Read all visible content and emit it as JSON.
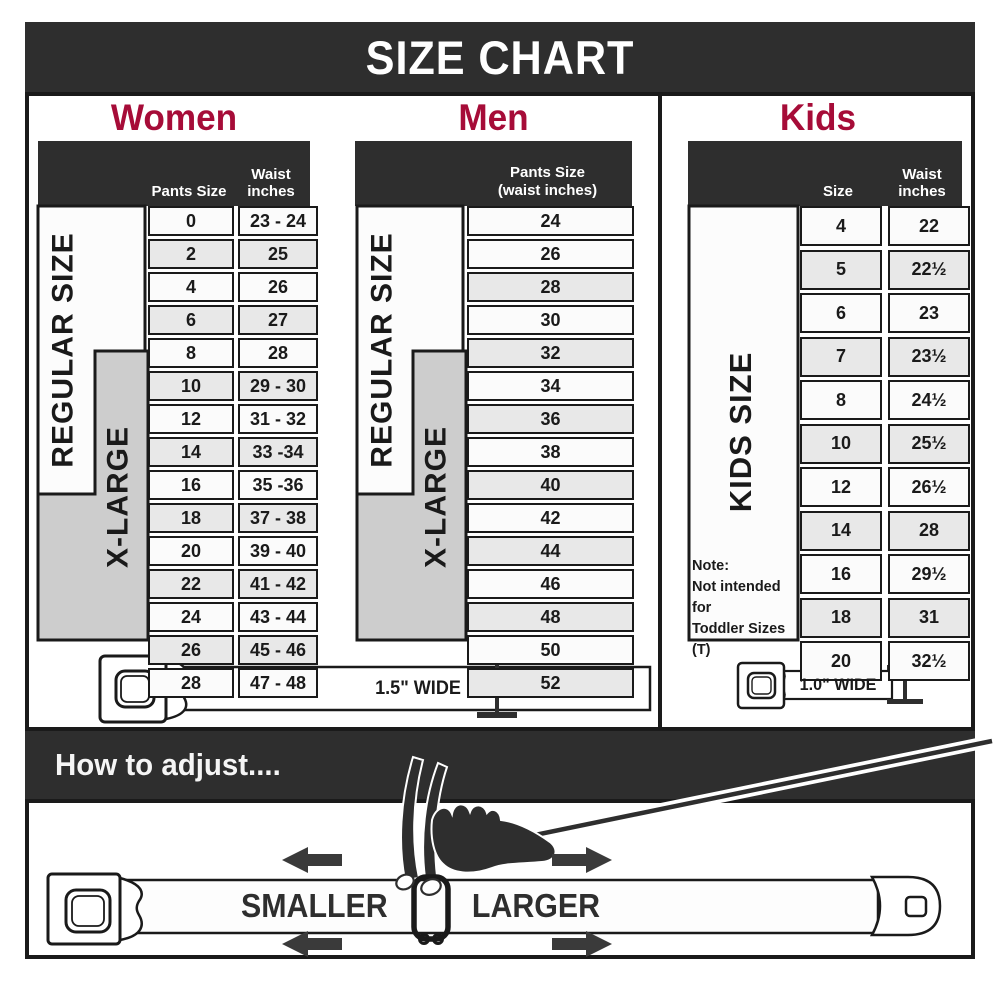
{
  "title": "SIZE CHART",
  "colors": {
    "dark_band": "#2e2e2e",
    "heading_red": "#a60c38",
    "border_black": "#1a1a1a",
    "row_gray": "#e8e8e8",
    "xlarge_gray": "#cdcdcd"
  },
  "women": {
    "heading": "Women",
    "col1_header": "Pants Size",
    "col2_header_line1": "Waist",
    "col2_header_line2": "inches",
    "regular_label": "REGULAR SIZE",
    "xlarge_label": "X-LARGE",
    "belt_width_label": "1.5\" WIDE",
    "rows": [
      {
        "size": "0",
        "waist": "23 - 24"
      },
      {
        "size": "2",
        "waist": "25"
      },
      {
        "size": "4",
        "waist": "26"
      },
      {
        "size": "6",
        "waist": "27"
      },
      {
        "size": "8",
        "waist": "28"
      },
      {
        "size": "10",
        "waist": "29 - 30"
      },
      {
        "size": "12",
        "waist": "31 - 32"
      },
      {
        "size": "14",
        "waist": "33 -34"
      },
      {
        "size": "16",
        "waist": "35 -36"
      },
      {
        "size": "18",
        "waist": "37 - 38"
      },
      {
        "size": "20",
        "waist": "39 - 40"
      },
      {
        "size": "22",
        "waist": "41 - 42"
      },
      {
        "size": "24",
        "waist": "43 - 44"
      },
      {
        "size": "26",
        "waist": "45 - 46"
      },
      {
        "size": "28",
        "waist": "47 - 48"
      }
    ]
  },
  "men": {
    "heading": "Men",
    "col_header_line1": "Pants Size",
    "col_header_line2": "(waist inches)",
    "regular_label": "REGULAR SIZE",
    "xlarge_label": "X-LARGE",
    "rows": [
      "24",
      "26",
      "28",
      "30",
      "32",
      "34",
      "36",
      "38",
      "40",
      "42",
      "44",
      "46",
      "48",
      "50",
      "52"
    ]
  },
  "kids": {
    "heading": "Kids",
    "col1_header": "Size",
    "col2_header_line1": "Waist",
    "col2_header_line2": "inches",
    "side_label": "KIDS SIZE",
    "note_line1": "Note:",
    "note_line2": "Not intended for",
    "note_line3": "Toddler Sizes (T)",
    "belt_width_label": "1.0\" WIDE",
    "rows": [
      {
        "size": "4",
        "waist": "22"
      },
      {
        "size": "5",
        "waist": "22½"
      },
      {
        "size": "6",
        "waist": "23"
      },
      {
        "size": "7",
        "waist": "23½"
      },
      {
        "size": "8",
        "waist": "24½"
      },
      {
        "size": "10",
        "waist": "25½"
      },
      {
        "size": "12",
        "waist": "26½"
      },
      {
        "size": "14",
        "waist": "28"
      },
      {
        "size": "16",
        "waist": "29½"
      },
      {
        "size": "18",
        "waist": "31"
      },
      {
        "size": "20",
        "waist": "32½"
      }
    ]
  },
  "adjust": {
    "heading": "How to adjust....",
    "smaller_label": "SMALLER",
    "larger_label": "LARGER"
  }
}
